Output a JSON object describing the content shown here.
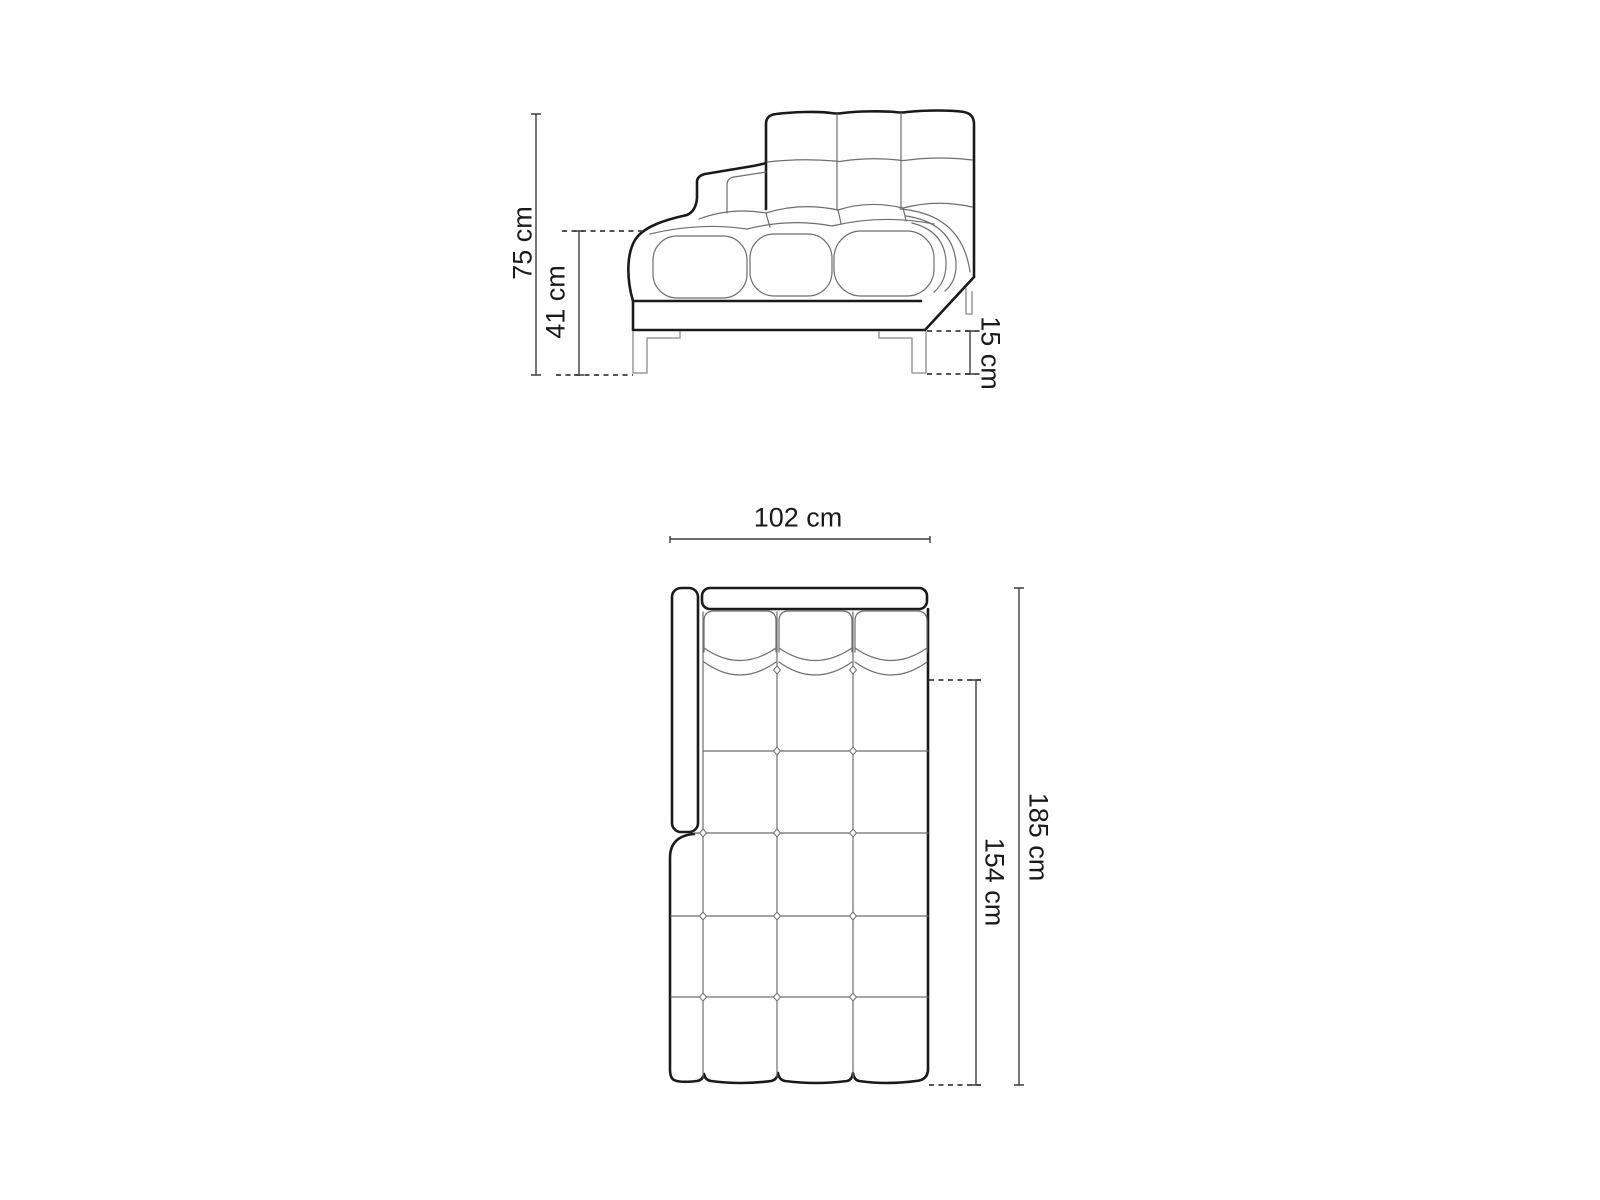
{
  "page": {
    "background": "#ffffff"
  },
  "drawing": {
    "type": "furniture-dimension-diagram",
    "subject": "tufted chaise longue sofa, side elevation and plan view",
    "units": "cm",
    "colors": {
      "background": "#ffffff",
      "outline": "#1a1a1a",
      "detail_line": "#6e6e6e",
      "leg_line": "#9a9a9a",
      "dimension_line": "#3d3d3d",
      "label_text": "#1a1a1a"
    },
    "side_view": {
      "labels": {
        "total_height": "75 cm",
        "seat_height": "41 cm",
        "leg_height": "15 cm"
      },
      "values": {
        "total_height_cm": 75,
        "seat_height_cm": 41,
        "leg_height_cm": 15
      }
    },
    "plan_view": {
      "labels": {
        "width": "102 cm",
        "total_depth": "185 cm",
        "seat_depth": "154 cm"
      },
      "values": {
        "width_cm": 102,
        "total_depth_cm": 185,
        "seat_depth_cm": 154
      }
    }
  }
}
